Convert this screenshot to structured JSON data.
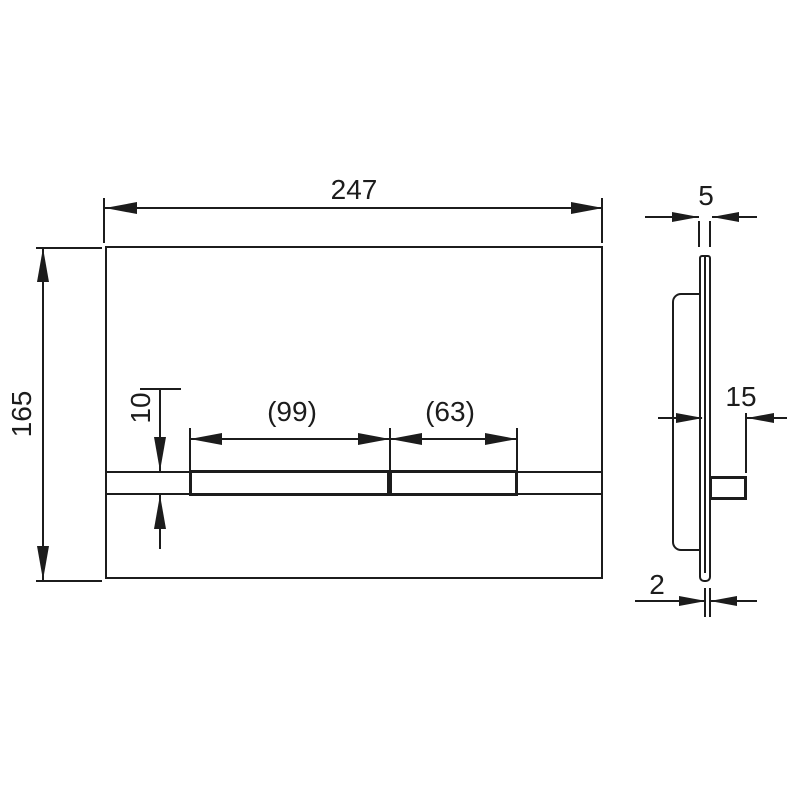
{
  "drawing": {
    "type": "technical-dimension-drawing",
    "subject": "wc-flush-plate",
    "line_color": "#1c1c1c",
    "background_color": "#ffffff",
    "front": {
      "overall_width": "247",
      "overall_height": "165",
      "button_strip_height": "10",
      "large_button_width": "(99)",
      "small_button_width": "(63)"
    },
    "side": {
      "overall_thickness": "5",
      "button_projection": "15",
      "panel_thickness": "2"
    }
  }
}
